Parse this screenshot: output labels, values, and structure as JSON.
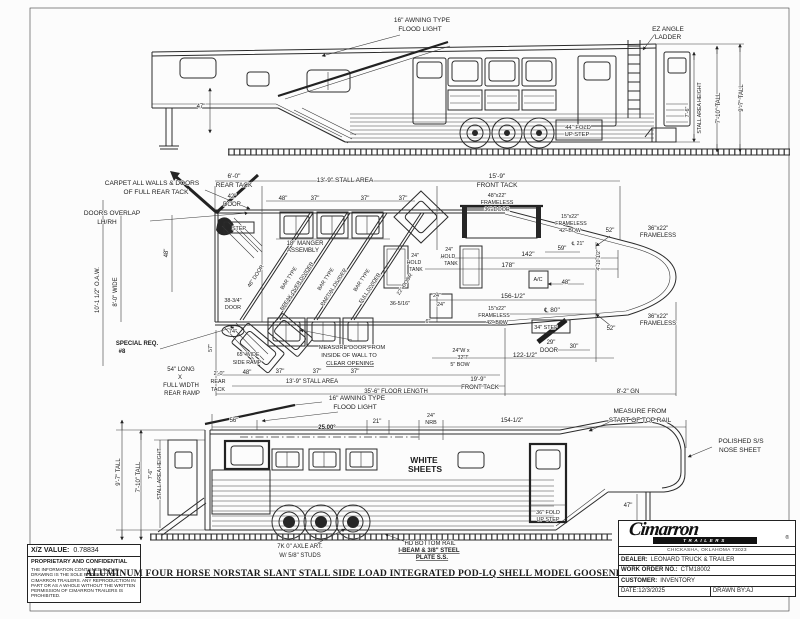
{
  "drawing_title": "ALUMINUM FOUR HORSE NORSTAR SLANT STALL SIDE LOAD INTEGRATED POD-LQ SHELL MODEL GOOSENECK TRAILER",
  "info_box": {
    "xz_label": "X/Z VALUE:",
    "xz_value": "0.78834",
    "confidential_title": "PROPRIETARY AND CONFIDENTIAL",
    "confidential_body": "THE INFORMATION CONTAINED IN THIS DRAWING IS THE SOLE PROPERTY OF CIMARRON TRAILERS. ANY REPRODUCTION IN PART OR AS A WHOLE WITHOUT THE WRITTEN PERMISSION OF CIMARRON TRAILERS IS PROHIBITED."
  },
  "title_block": {
    "brand": "Cimarron",
    "brand_sub": "TRAILERS",
    "registered": "®",
    "address": "CHICKASHA, OKLAHOMA 73023",
    "rows": [
      {
        "label": "DEALER:",
        "value": "LEONARD TRUCK & TRAILER"
      },
      {
        "label": "WORK ORDER NO.:",
        "value": "CTM18002"
      },
      {
        "label": "CUSTOMER:",
        "value": "INVENTORY"
      }
    ],
    "date_label": "DATE:",
    "date_value": "12/3/2025",
    "drawn_by_label": "DRAWN BY:",
    "drawn_by_value": "AJ"
  },
  "views": {
    "top_view": {
      "labels": [
        {
          "t": "16\" AWNING TYPE",
          "x": 422,
          "y": 22,
          "n": "awning-flood-light-note"
        },
        {
          "t": "FLOOD LIGHT",
          "x": 420,
          "y": 31,
          "n": "awning-flood-light-note"
        },
        {
          "t": "EZ ANGLE",
          "x": 668,
          "y": 31,
          "n": "ez-angle-ladder-note"
        },
        {
          "t": "LADDER",
          "x": 668,
          "y": 39,
          "n": "ez-angle-ladder-note"
        },
        {
          "t": "44\" FOLD",
          "x": 578,
          "y": 129,
          "s": 5.8,
          "n": "fold-up-step-note"
        },
        {
          "t": "UP STEP",
          "x": 577,
          "y": 136,
          "s": 5.8,
          "n": "fold-up-step-note"
        },
        {
          "t": "47\"",
          "x": 201,
          "y": 108,
          "s": 6,
          "n": "gooseneck-drop-dim"
        },
        {
          "t": "7'-6\"",
          "x": 689,
          "y": 112,
          "r": -90,
          "s": 5.4,
          "n": "stall-height-dim"
        },
        {
          "t": "STALL AREA HEIGHT",
          "x": 701,
          "y": 108,
          "r": -90,
          "s": 5.2,
          "n": "stall-height-dim"
        },
        {
          "t": "7'-10\" TALL",
          "x": 720,
          "y": 108,
          "r": -90,
          "s": 6,
          "n": "wall-height-dim"
        },
        {
          "t": "9'-7\" TALL",
          "x": 743,
          "y": 98,
          "r": -90,
          "s": 6,
          "n": "overall-height-dim"
        }
      ]
    },
    "floor_plan": {
      "labels": [
        {
          "t": "CARPET ALL WALLS & DOORS",
          "x": 152,
          "y": 185,
          "n": "carpet-note"
        },
        {
          "t": "OF FULL REAR TACK",
          "x": 156,
          "y": 194,
          "n": "carpet-note"
        },
        {
          "t": "DOORS OVERLAP",
          "x": 112,
          "y": 215,
          "n": "doors-overlap-note"
        },
        {
          "t": "LH/RH",
          "x": 107,
          "y": 224,
          "n": "doors-overlap-note"
        },
        {
          "t": "6'-0\"",
          "x": 234,
          "y": 178
        },
        {
          "t": "REAR TACK",
          "x": 234,
          "y": 187
        },
        {
          "t": "13'-9\" STALL AREA",
          "x": 345,
          "y": 182
        },
        {
          "t": "15'-9\"",
          "x": 497,
          "y": 178
        },
        {
          "t": "FRONT TACK",
          "x": 497,
          "y": 187
        },
        {
          "t": "48\"x22\"",
          "x": 497,
          "y": 197,
          "s": 5.4
        },
        {
          "t": "FRAMELESS",
          "x": 497,
          "y": 204,
          "s": 5.4
        },
        {
          "t": "36\" DOOR",
          "x": 497,
          "y": 211,
          "s": 5.4
        },
        {
          "t": "42\"",
          "x": 232,
          "y": 198,
          "s": 6
        },
        {
          "t": "DOOR",
          "x": 232,
          "y": 206,
          "s": 6
        },
        {
          "t": "48\"",
          "x": 283,
          "y": 200,
          "s": 6
        },
        {
          "t": "37\"",
          "x": 315,
          "y": 200,
          "s": 6
        },
        {
          "t": "37\"",
          "x": 365,
          "y": 200,
          "s": 6
        },
        {
          "t": "37\"",
          "x": 403,
          "y": 200,
          "s": 6
        },
        {
          "t": "STEP",
          "x": 239,
          "y": 230,
          "s": 5.4
        },
        {
          "t": "18\" MANGER",
          "x": 305,
          "y": 245,
          "s": 6,
          "n": "manger-note"
        },
        {
          "t": "ASSEMBLY",
          "x": 303,
          "y": 252,
          "s": 6,
          "n": "manger-note"
        },
        {
          "t": "10'-1 1/2\" O.A.W.",
          "x": 99,
          "y": 290,
          "r": -90,
          "s": 6,
          "n": "overall-width-dim"
        },
        {
          "t": "8'-0\" WIDE",
          "x": 117,
          "y": 292,
          "r": -90,
          "s": 6
        },
        {
          "t": "48\"",
          "x": 168,
          "y": 253,
          "r": -90,
          "s": 6
        },
        {
          "t": "48\" DOOR",
          "x": 257,
          "y": 277,
          "r": -57,
          "s": 5.4
        },
        {
          "t": "BAR TYPE",
          "x": 290,
          "y": 279,
          "r": -57,
          "s": 5.2,
          "n": "divider-note"
        },
        {
          "t": "BREAK-OVER DIVIDER",
          "x": 298,
          "y": 287,
          "r": -57,
          "s": 5.2,
          "n": "divider-note"
        },
        {
          "t": "BAR TYPE",
          "x": 327,
          "y": 280,
          "r": -57,
          "s": 5.2,
          "n": "divider-note"
        },
        {
          "t": "PARTIAL DIVIDER",
          "x": 335,
          "y": 288,
          "r": -57,
          "s": 5.2,
          "n": "divider-note"
        },
        {
          "t": "BAR TYPE",
          "x": 363,
          "y": 281,
          "r": -57,
          "s": 5.2,
          "n": "divider-note"
        },
        {
          "t": "FULL DIVIDER",
          "x": 371,
          "y": 289,
          "r": -57,
          "s": 5.2,
          "n": "divider-note"
        },
        {
          "t": "22\" DOOR",
          "x": 406,
          "y": 285,
          "r": -57,
          "s": 5.2
        },
        {
          "t": "38-3/4\"",
          "x": 233,
          "y": 302,
          "s": 5.4
        },
        {
          "t": "DOOR",
          "x": 233,
          "y": 309,
          "s": 5.4
        },
        {
          "t": "24\"",
          "x": 415,
          "y": 257,
          "s": 5.2,
          "n": "hold-tank-note"
        },
        {
          "t": "HOLD",
          "x": 414,
          "y": 264,
          "s": 5.2,
          "n": "hold-tank-note"
        },
        {
          "t": "TANK",
          "x": 416,
          "y": 271,
          "s": 5.2,
          "n": "hold-tank-note"
        },
        {
          "t": "24\"",
          "x": 449,
          "y": 251,
          "s": 5.2,
          "n": "hold-tank-note"
        },
        {
          "t": "HOLD",
          "x": 448,
          "y": 258,
          "s": 5.2,
          "n": "hold-tank-note"
        },
        {
          "t": "TANK",
          "x": 451,
          "y": 265,
          "s": 5.2,
          "n": "hold-tank-note"
        },
        {
          "t": "36-5/16\"",
          "x": 400,
          "y": 305,
          "s": 5.4
        },
        {
          "t": "24\"",
          "x": 437,
          "y": 297,
          "s": 5.4
        },
        {
          "t": "24\"",
          "x": 441,
          "y": 306,
          "s": 5.4
        },
        {
          "t": "6\"",
          "x": 428,
          "y": 323,
          "s": 5.4
        },
        {
          "t": "142\"",
          "x": 528,
          "y": 256
        },
        {
          "t": "178\"",
          "x": 508,
          "y": 267
        },
        {
          "t": "156-1/2\"",
          "x": 513,
          "y": 298
        },
        {
          "t": "℄ 80\"",
          "x": 552,
          "y": 312
        },
        {
          "t": "15\"x22\"",
          "x": 570,
          "y": 218,
          "s": 5.2
        },
        {
          "t": "FRAMELESS",
          "x": 571,
          "y": 225,
          "s": 5.2
        },
        {
          "t": "42\" BOW",
          "x": 570,
          "y": 232,
          "s": 5.2
        },
        {
          "t": "15\"x22\"",
          "x": 497,
          "y": 310,
          "s": 5.2
        },
        {
          "t": "FRAMELESS",
          "x": 494,
          "y": 317,
          "s": 5.2
        },
        {
          "t": "42\" BOW",
          "x": 497,
          "y": 324,
          "s": 5.2
        },
        {
          "t": "59\"",
          "x": 562,
          "y": 250,
          "s": 6
        },
        {
          "t": "℄ 21\"",
          "x": 578,
          "y": 245,
          "s": 5.2
        },
        {
          "t": "A/C",
          "x": 538,
          "y": 281,
          "s": 5.4,
          "n": "ac-unit-label"
        },
        {
          "t": "48\"",
          "x": 566,
          "y": 284,
          "s": 6
        },
        {
          "t": "34\" STEP",
          "x": 546,
          "y": 329,
          "s": 5.4
        },
        {
          "t": "29\"",
          "x": 551,
          "y": 344,
          "s": 6
        },
        {
          "t": "DOOR",
          "x": 549,
          "y": 352,
          "s": 6
        },
        {
          "t": "30\"",
          "x": 574,
          "y": 348,
          "s": 6
        },
        {
          "t": "24\"W x",
          "x": 461,
          "y": 352,
          "s": 5.4
        },
        {
          "t": "32\"T",
          "x": 463,
          "y": 359,
          "s": 5.4
        },
        {
          "t": "5\" BOW",
          "x": 460,
          "y": 366,
          "s": 5.4
        },
        {
          "t": "122-1/2\"",
          "x": 525,
          "y": 357
        },
        {
          "t": "52\"",
          "x": 610,
          "y": 232,
          "s": 6
        },
        {
          "t": "36\"x22\"",
          "x": 658,
          "y": 230,
          "s": 6
        },
        {
          "t": "FRAMELESS",
          "x": 658,
          "y": 237,
          "s": 6
        },
        {
          "t": "36\"x22\"",
          "x": 658,
          "y": 318,
          "s": 6
        },
        {
          "t": "FRAMELESS",
          "x": 658,
          "y": 325,
          "s": 6
        },
        {
          "t": "52\"",
          "x": 611,
          "y": 330,
          "s": 6
        },
        {
          "t": "4'-10 1/2\"",
          "x": 600,
          "y": 260,
          "r": -90,
          "s": 5
        },
        {
          "t": "SPECIAL REQ.",
          "x": 137,
          "y": 345,
          "b": 1,
          "s": 6,
          "n": "special-req-note"
        },
        {
          "t": "#8",
          "x": 122,
          "y": 353,
          "b": 1,
          "s": 6,
          "n": "special-req-note"
        },
        {
          "t": "MEASURE DOOR F­ROM",
          "x": 352,
          "y": 349,
          "s": 5.8,
          "n": "measure-door-note"
        },
        {
          "t": "INSIDE OF WALL TO",
          "x": 349,
          "y": 357,
          "s": 5.8,
          "n": "measure-door-note"
        },
        {
          "t": "CLEAR OPENING",
          "x": 350,
          "y": 365,
          "s": 5.8,
          "u": 1,
          "n": "measure-door-note"
        },
        {
          "t": "74\"",
          "x": 233,
          "y": 333,
          "s": 5.4
        },
        {
          "t": "57\"",
          "x": 212,
          "y": 348,
          "r": -90,
          "s": 5.4
        },
        {
          "t": "65\" WIDE",
          "x": 248,
          "y": 356,
          "s": 5.2,
          "n": "side-ramp-note"
        },
        {
          "t": "SIDE RAMP",
          "x": 247,
          "y": 364,
          "s": 5.2,
          "n": "side-ramp-note"
        },
        {
          "t": "54\" LONG",
          "x": 181,
          "y": 371,
          "s": 6,
          "n": "rear-ramp-note"
        },
        {
          "t": "X",
          "x": 180,
          "y": 379,
          "s": 6,
          "n": "rear-ramp-note"
        },
        {
          "t": "FULL WIDTH",
          "x": 181,
          "y": 387,
          "s": 6,
          "n": "rear-ramp-note"
        },
        {
          "t": "REAR RAMP",
          "x": 182,
          "y": 395,
          "s": 6,
          "n": "rear-ramp-note"
        },
        {
          "t": "2'-0\"",
          "x": 219,
          "y": 375,
          "s": 5.4
        },
        {
          "t": "REAR",
          "x": 218,
          "y": 383,
          "s": 5.4
        },
        {
          "t": "TACK",
          "x": 218,
          "y": 391,
          "s": 5.4
        },
        {
          "t": "48\"",
          "x": 247,
          "y": 374,
          "s": 6
        },
        {
          "t": "37\"",
          "x": 280,
          "y": 373,
          "s": 6
        },
        {
          "t": "37\"",
          "x": 317,
          "y": 373,
          "s": 6
        },
        {
          "t": "37\"",
          "x": 355,
          "y": 373,
          "s": 6
        },
        {
          "t": "13'-9\" STALL AREA",
          "x": 312,
          "y": 383,
          "s": 6
        },
        {
          "t": "19'-9\"",
          "x": 478,
          "y": 381,
          "s": 6
        },
        {
          "t": "FRONT TACK",
          "x": 480,
          "y": 389,
          "s": 6
        },
        {
          "t": "35'-6\" FLOOR LENGTH",
          "x": 396,
          "y": 393,
          "s": 6,
          "n": "floor-length-dim"
        },
        {
          "t": "8'-2\" GN",
          "x": 628,
          "y": 393,
          "s": 6,
          "n": "gooseneck-length-dim"
        }
      ]
    },
    "bottom_view": {
      "labels": [
        {
          "t": "16\" AWNING TYPE",
          "x": 357,
          "y": 400,
          "n": "awning-flood-light-note"
        },
        {
          "t": "FLOOD LIGHT",
          "x": 355,
          "y": 409,
          "n": "awning-flood-light-note"
        },
        {
          "t": "25.00°",
          "x": 327,
          "y": 429,
          "b": 1,
          "s": 6,
          "n": "angle-dim"
        },
        {
          "t": "56\"",
          "x": 234,
          "y": 422,
          "s": 6
        },
        {
          "t": "21\"",
          "x": 377,
          "y": 423,
          "s": 6
        },
        {
          "t": "24\"",
          "x": 431,
          "y": 417,
          "s": 5.4
        },
        {
          "t": "NRB",
          "x": 431,
          "y": 424,
          "s": 5.4
        },
        {
          "t": "154-1/2\"",
          "x": 512,
          "y": 422,
          "s": 6
        },
        {
          "t": "MEASURE FROM",
          "x": 640,
          "y": 413,
          "n": "top-rail-note"
        },
        {
          "t": "START OF TOP RAIL",
          "x": 640,
          "y": 422,
          "n": "top-rail-note"
        },
        {
          "t": "POLISHED S/S",
          "x": 741,
          "y": 443,
          "n": "nose-sheet-note"
        },
        {
          "t": "NOSE SHEET",
          "x": 740,
          "y": 452,
          "n": "nose-sheet-note"
        },
        {
          "t": "WHITE",
          "x": 424,
          "y": 463,
          "b": 1,
          "s": 8.5,
          "f": 1,
          "n": "white-sheets-note"
        },
        {
          "t": "SHEETS",
          "x": 425,
          "y": 472,
          "b": 1,
          "s": 8.5,
          "f": 1,
          "n": "white-sheets-note"
        },
        {
          "t": "36\" FOLD",
          "x": 548,
          "y": 514,
          "s": 5.4,
          "n": "fold-up-step-note"
        },
        {
          "t": "UP STEP",
          "x": 548,
          "y": 521,
          "s": 5.4,
          "n": "fold-up-step-note"
        },
        {
          "t": "47\"",
          "x": 628,
          "y": 507,
          "s": 6,
          "n": "gooseneck-drop-dim"
        },
        {
          "t": "9'-7\" TALL",
          "x": 120,
          "y": 472,
          "r": -90,
          "s": 6,
          "n": "overall-height-dim"
        },
        {
          "t": "7'-10\" TALL",
          "x": 140,
          "y": 477,
          "r": -90,
          "s": 6,
          "n": "wall-height-dim"
        },
        {
          "t": "7'-6\"",
          "x": 152,
          "y": 474,
          "r": -90,
          "s": 5.2,
          "n": "stall-height-dim"
        },
        {
          "t": "STALL AREA HEIGHT",
          "x": 161,
          "y": 474,
          "r": -90,
          "s": 5.2,
          "n": "stall-height-dim"
        },
        {
          "t": "7K 0\" AXLE ART.",
          "x": 300,
          "y": 548,
          "s": 6,
          "n": "axle-note"
        },
        {
          "t": "W/ 5/8\" STUDS",
          "x": 300,
          "y": 557,
          "s": 6,
          "n": "axle-note"
        },
        {
          "t": "HD BOTTOM RAIL",
          "x": 430,
          "y": 545,
          "s": 6,
          "n": "bottom-rail-note"
        },
        {
          "t": "I-BEAM & 3/8\" STEEL",
          "x": 429,
          "y": 552,
          "s": 6,
          "b": 1,
          "u": 1,
          "n": "bottom-rail-note"
        },
        {
          "t": "PLATE S.S.",
          "x": 432,
          "y": 559,
          "s": 6,
          "b": 1,
          "u": 1,
          "n": "bottom-rail-note"
        }
      ]
    }
  }
}
